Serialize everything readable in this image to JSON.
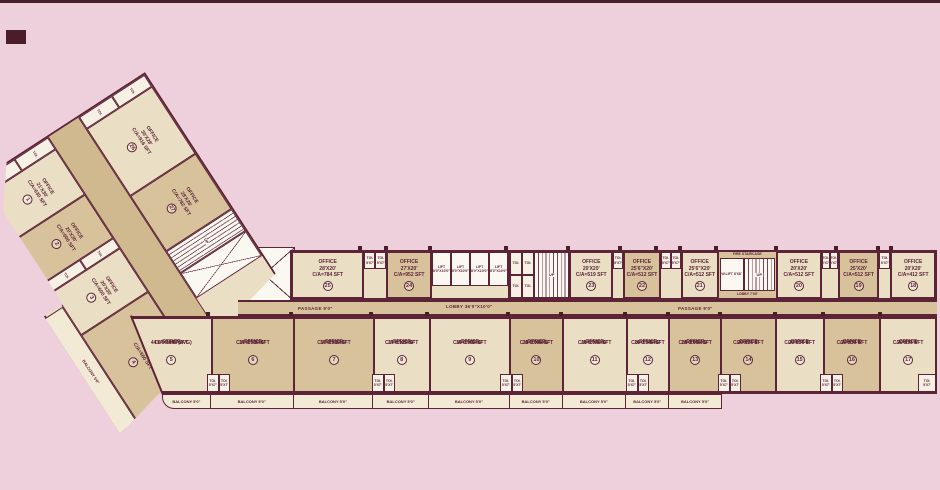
{
  "office_word": "OFFICE",
  "labels": {
    "passage": "PASSAGE 9'0\"",
    "lobby_main": "LOBBY 36'0\"X10'0\"",
    "lobby_fire": "LOBBY 7'X9'",
    "fire_stair": "FIRE STAIRCASE",
    "w_lift": "W.LIFT 8'X8'",
    "lift_line1": "LIFT",
    "lift_line2": "8'0\"X10'0\"",
    "toilet": "TOI. 5'X7'",
    "toilet_small": "TOI.",
    "up": "UP",
    "balcony": "BALCONY 5'0\""
  },
  "top_row": [
    {
      "no": "25",
      "size": "28'X20'",
      "area": "C/A=784 SFT"
    },
    {
      "no": "24",
      "size": "27'X20'",
      "area": "C/A=952 SFT"
    },
    {
      "no": "23",
      "size": "20'X20'",
      "area": "C/A=519 SFT"
    },
    {
      "no": "22",
      "size": "25'6\"X20'",
      "area": "C/A=512 SFT"
    },
    {
      "no": "21",
      "size": "25'6\"X20'",
      "area": "C/A=512 SFT"
    },
    {
      "no": "20",
      "size": "20'X20'",
      "area": "C/A=512 SFT"
    },
    {
      "no": "19",
      "size": "25'X20'",
      "area": "C/A=512 SFT"
    },
    {
      "no": "18",
      "size": "20'X20'",
      "area": "C/A=412 SFT"
    }
  ],
  "bottom_row": [
    {
      "no": "5",
      "size": "44'6\"X34'6\"(AVG)",
      "area": "C/A=1508 SFT"
    },
    {
      "no": "6",
      "size": "37'9\"X34'6\"",
      "area": "C/A=1036 SFT"
    },
    {
      "no": "7",
      "size": "37'9\"X34'6\"",
      "area": "C/A=1036 SFT"
    },
    {
      "no": "8",
      "size": "27'6\"X34'6\"",
      "area": "C/A=1126 SFT"
    },
    {
      "no": "9",
      "size": "30'0\"X34'6\"",
      "area": "C/A=1003 SFT"
    },
    {
      "no": "10",
      "size": "25'0\"X34'6\"",
      "area": "C/A=1046 SFT"
    },
    {
      "no": "11",
      "size": "25'6\"X34'6\"",
      "area": "C/A=1046 SFT"
    },
    {
      "no": "12",
      "size": "25'0\"X34'6\"",
      "area": "C/A=1046 SFT"
    },
    {
      "no": "13",
      "size": "25'0\"X34'6\"",
      "area": "C/A=1046 SFT"
    },
    {
      "no": "14",
      "size": "20'X34'6\"",
      "area": "C/A=677 SFT"
    },
    {
      "no": "15",
      "size": "20'X34'6\"",
      "area": "C/A=677 SFT"
    },
    {
      "no": "16",
      "size": "20'X34'6\"",
      "area": "C/A=677 SFT"
    },
    {
      "no": "17",
      "size": "20'X34'6\"",
      "area": "C/A=677 SFT"
    }
  ],
  "wing": {
    "inner": [
      {
        "no": "26",
        "size": "30'X28'",
        "area": "C/A=916 SFT"
      },
      {
        "no": "27",
        "size": "28'X26'",
        "area": "C/A=782 SFT"
      }
    ],
    "outer": [
      {
        "no": "1",
        "size": "21'X30'",
        "area": "C/A=630 SFT"
      },
      {
        "no": "2",
        "size": "20'X30'",
        "area": "C/A=600 SFT"
      },
      {
        "no": "3",
        "size": "20'X30'",
        "area": "C/A=600 SFT"
      },
      {
        "no": "4",
        "size": "22'X30'",
        "area": "C/A=660 SFT"
      }
    ]
  }
}
